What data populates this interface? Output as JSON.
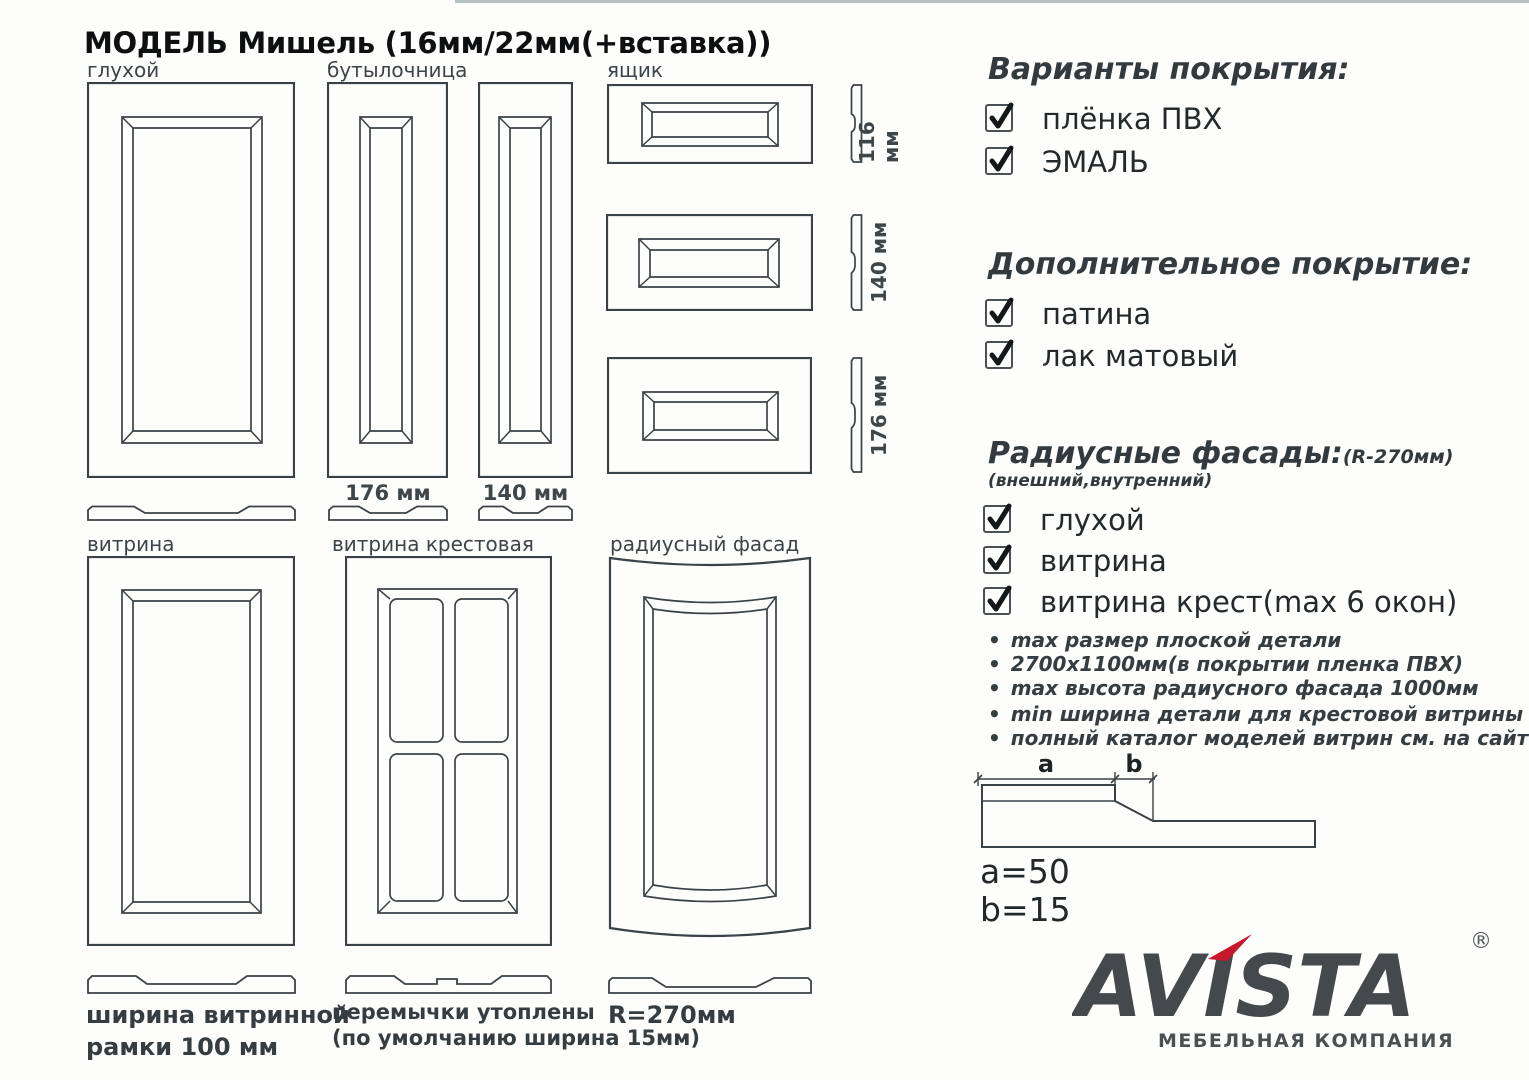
{
  "page": {
    "title": "МОДЕЛЬ Мишель (16мм/22мм(+вставка))"
  },
  "drawings": {
    "solid_label": "глухой",
    "bottle_label": "бутылочница",
    "drawer_label": "ящик",
    "dim_176": "176 мм",
    "dim_140": "140 мм",
    "drawer_dims": [
      "116 мм",
      "140 мм",
      "176 мм"
    ],
    "vitrine_label": "витрина",
    "vitrine_cross_label": "витрина крестовая",
    "radius_label": "радиусный фасад",
    "vitrine_note_line1": "ширина витринной",
    "vitrine_note_line2": "рамки 100 мм",
    "cross_note_line1": "перемычки утоплены",
    "cross_note_line2": "(по умолчанию ширина 15мм)",
    "radius_note": "R=270мм"
  },
  "options": {
    "coating": {
      "title": "Варианты покрытия:",
      "items": [
        "плёнка ПВХ",
        "ЭМАЛЬ"
      ]
    },
    "extra_coating": {
      "title": "Дополнительное покрытие:",
      "items": [
        "патина",
        "лак матовый"
      ]
    },
    "radius_facades": {
      "title": "Радиусные фасады:",
      "title_suffix": "(R-270мм)",
      "subtitle": "(внешний,внутренний)",
      "items": [
        "глухой",
        "витрина",
        "витрина крест(max 6 окон)"
      ]
    },
    "notes": [
      "max размер плоской детали",
      "2700х1100мм(в покрытии пленка ПВХ)",
      "max высота радиусного фасада 1000мм",
      "min ширина детали для крестовой витрины 246мм",
      "полный каталог моделей витрин см. на сайте"
    ]
  },
  "profile": {
    "dim_a": "a",
    "dim_b": "b",
    "a_value": "a=50",
    "b_value": "b=15"
  },
  "logo": {
    "name": "AVISTA",
    "registered": "®",
    "tagline": "МЕБЕЛЬНАЯ КОМПАНИЯ"
  },
  "colors": {
    "line": "#3b4247",
    "accent_red": "#c6182b",
    "logo_gray": "#45494c"
  }
}
